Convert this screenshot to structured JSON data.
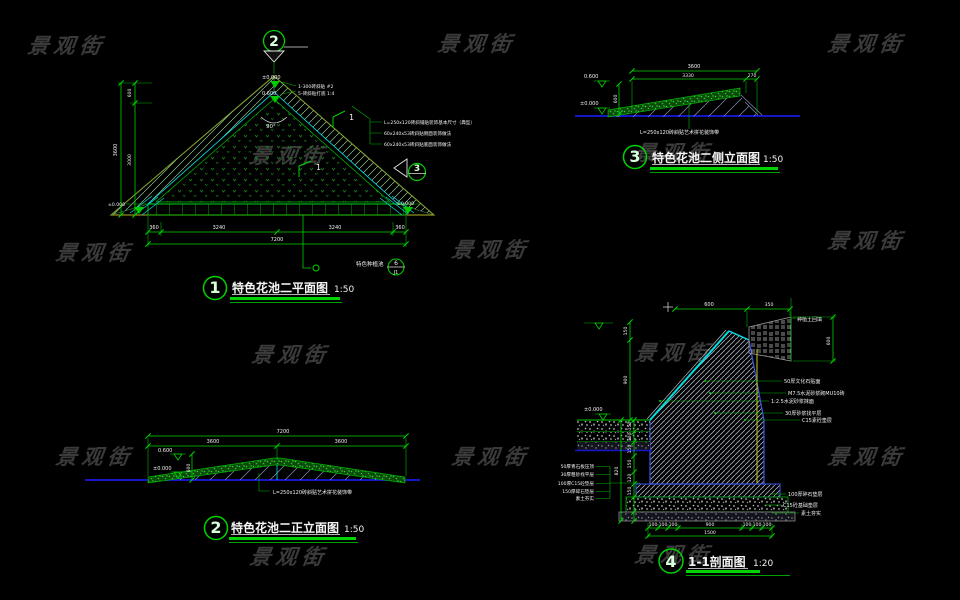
{
  "watermark": {
    "text": "景观街"
  },
  "d1": {
    "num": "1",
    "title": "特色花池二平面图",
    "scale": "1:50",
    "view_marker_top": "2",
    "view_marker_side": "3",
    "apex_elev_upper": "±0.000",
    "apex_elev_lower": "0.600",
    "apex_note_1": "1-300砖斜贴 #2",
    "apex_note_2": "5-砖斜贴打底 1:4",
    "angle_label": "90°",
    "keynote_1": "1",
    "keynote_2": "1",
    "right_notes": [
      "L=250x120砖斜铺贴装饰基本尺寸（典型）",
      "60x240x53砖斜贴侧面装饰做法",
      "60x240x53砖斜贴底面装饰做法"
    ],
    "left_dims": {
      "total": "3600",
      "top": "600",
      "bottom": "3000"
    },
    "bottom_dims": [
      "360",
      "3240",
      "3240",
      "360"
    ],
    "bottom_total": "7200",
    "corner_elev_left": "±0.000",
    "corner_elev_right": "±0.000",
    "leader_label": "特色种植池",
    "bubble_top": "6",
    "bubble_bottom": "J1"
  },
  "d2": {
    "num": "2",
    "title": "特色花池二正立面图",
    "scale": "1:50",
    "dim_total": "7200",
    "dim_left": "3600",
    "dim_right": "3600",
    "elev_top": "0.600",
    "elev_zero": "±0.000",
    "dim_height": "600",
    "note": "L=250x120砖斜贴艺术拼花装饰带"
  },
  "d3": {
    "num": "3",
    "title": "特色花池二侧立面图",
    "scale": "1:50",
    "dim_total": "3600",
    "dim_a": "3330",
    "dim_b": "270",
    "elev_top": "0.600",
    "elev_zero": "±0.000",
    "dim_height": "600",
    "note": "L=250x120砖斜贴艺术拼花装饰带"
  },
  "d4": {
    "num": "4",
    "title": "1-1剖面图",
    "scale": "1:20",
    "top_dim_a": "600",
    "top_dim_b": "350",
    "upper_vdim_a": "150",
    "upper_vdim_b": "900",
    "right_vdim": "600",
    "elev_zero": "±0.000",
    "roof_label": "种植土回填",
    "wall_labels": [
      "50厚文化石贴面",
      "M7.5水泥砂浆砌MU10砖",
      "1:2.5水泥砂浆抹面",
      "30厚砂浆找平层",
      "C15素砼垫层"
    ],
    "base_labels": [
      "100厚碎石垫层",
      "C15砼基础垫层",
      "素土夯实"
    ],
    "left_labels": [
      "50厚青石板压顶",
      "30厚粗砂找平层",
      "100厚C15砼垫层",
      "150厚碎石垫层",
      "素土夯实"
    ],
    "vchain": [
      "150",
      "100",
      "150",
      "150",
      "120",
      "150"
    ],
    "vchain_total": "820",
    "bottom_dims": [
      "100",
      "100",
      "100",
      "900",
      "100",
      "100",
      "100"
    ],
    "bottom_total": "1500"
  }
}
